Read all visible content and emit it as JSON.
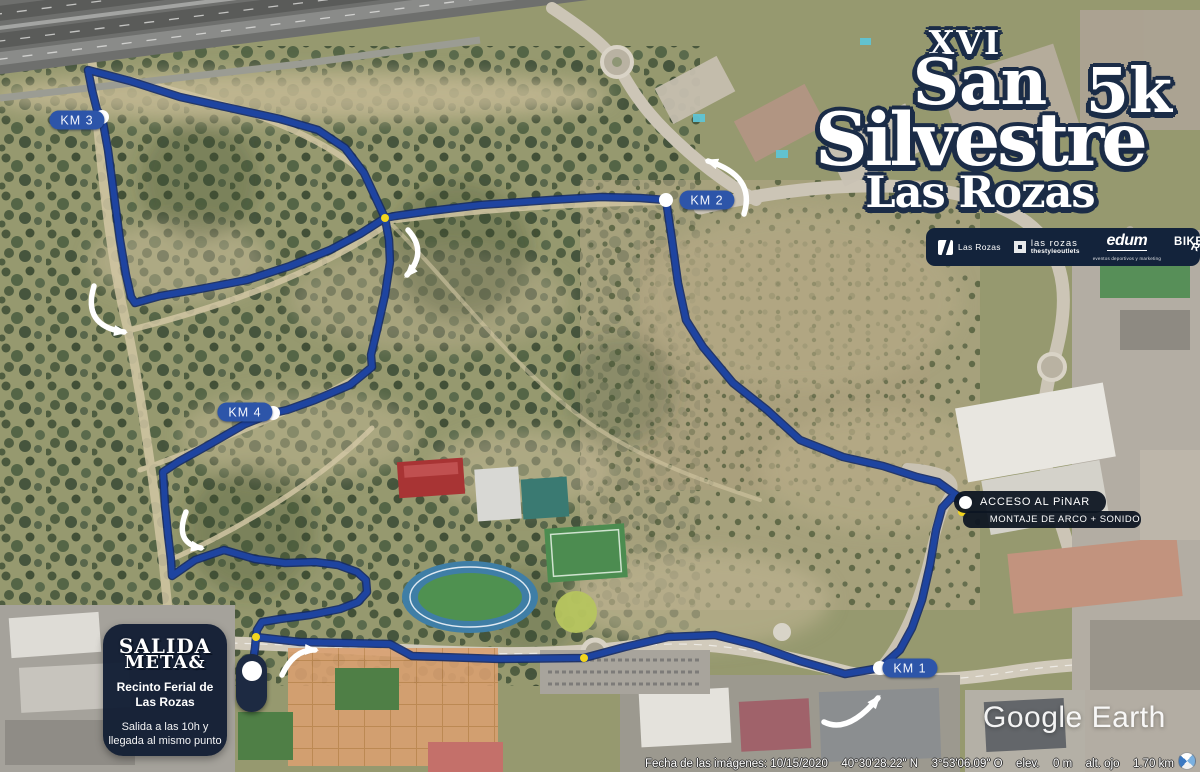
{
  "title": {
    "edition": "XVI",
    "line1": "San",
    "line2": "Silvestre",
    "distance": "5k",
    "location": "Las Rozas"
  },
  "sponsors": {
    "items": [
      {
        "label": "Las Rozas"
      },
      {
        "line1": "las rozas",
        "line2": "thestyleoutlets"
      },
      {
        "word": "edum",
        "tagline": "eventos deportivos y marketing"
      },
      {
        "word1": "BIKE",
        "word2": "RUN"
      }
    ]
  },
  "route_markers": {
    "km1": "KM 1",
    "km2": "KM 2",
    "km3": "KM 3",
    "km4": "KM 4"
  },
  "labels": {
    "acceso": "ACCESO AL PiNAR",
    "montaje": "MONTAJE DE ARCO + SONIDO"
  },
  "start_box": {
    "title_line1": "SALIDA",
    "title_line2": "META&",
    "venue_line1": "Recinto Ferial de",
    "venue_line2": "Las Rozas",
    "note_line1": "Salida a las 10h y",
    "note_line2": "llegada al mismo punto"
  },
  "watermark": "Google Earth",
  "status_bar": {
    "imagery_date": "Fecha de las imágenes: 10/15/2020",
    "latitude": "40°30'28.22\" N",
    "longitude": "3°53'06.09\" O",
    "elev_label": "elev.",
    "elev_value": "0 m",
    "eye_alt_label": "alt. ojo",
    "eye_alt_value": "1.70 km"
  }
}
